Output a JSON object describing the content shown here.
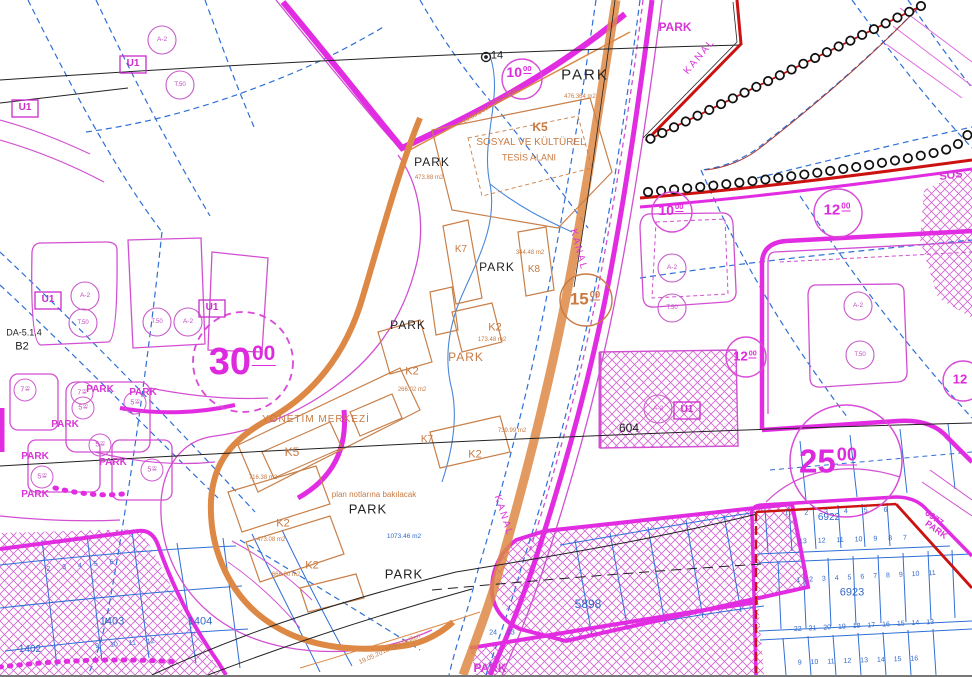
{
  "map": {
    "type": "turkish-zoning-cadastral-plan",
    "colors": {
      "magenta": "#de2ade",
      "magenta_thin": "#d24fd2",
      "blue": "#2f6fd6",
      "orange": "#d4813b",
      "orange_text": "#c87a42",
      "red": "#cc1111",
      "black": "#222222"
    },
    "labels": [
      {
        "id": "park-north",
        "t": "PARK",
        "x": 585,
        "y": 75,
        "s": 15,
        "c": "#222",
        "ls": 2
      },
      {
        "id": "park-k5-west",
        "t": "PARK",
        "x": 432,
        "y": 162,
        "s": 12,
        "c": "#222",
        "ls": 1
      },
      {
        "id": "park-center",
        "t": "PARK",
        "x": 497,
        "y": 267,
        "s": 12,
        "c": "#222",
        "ls": 1
      },
      {
        "id": "park-west",
        "t": "PARK",
        "x": 408,
        "y": 325,
        "s": 12,
        "c": "#222",
        "ls": 1
      },
      {
        "id": "park-south-1",
        "t": "PARK",
        "x": 368,
        "y": 509,
        "s": 13,
        "c": "#222",
        "ls": 1
      },
      {
        "id": "park-south-2",
        "t": "PARK",
        "x": 404,
        "y": 574,
        "s": 13,
        "c": "#222",
        "ls": 1
      },
      {
        "id": "point-14",
        "t": "14",
        "x": 497,
        "y": 56,
        "s": 11,
        "c": "#222"
      },
      {
        "id": "block-604",
        "t": "604",
        "x": 629,
        "y": 428,
        "s": 12,
        "c": "#222"
      },
      {
        "id": "plan-code-da514",
        "t": "DA-5.1.4",
        "x": 24,
        "y": 333,
        "s": 9,
        "c": "#222"
      },
      {
        "id": "plan-code-b2",
        "t": "B2",
        "x": 22,
        "y": 347,
        "s": 11,
        "c": "#222"
      },
      {
        "id": "park-orange",
        "t": "PARK",
        "x": 466,
        "y": 357,
        "s": 12,
        "c": "#c87a42",
        "ls": 1
      },
      {
        "id": "k5-title",
        "t": "K5",
        "x": 540,
        "y": 127,
        "s": 12,
        "c": "#c87a42",
        "b": 1
      },
      {
        "id": "k5-subtitle-1",
        "t": "SOSYAL VE KÜLTÜREL",
        "x": 531,
        "y": 143,
        "s": 10,
        "c": "#c87a42"
      },
      {
        "id": "k5-subtitle-2",
        "t": "TESİS ALANI",
        "x": 529,
        "y": 158,
        "s": 9,
        "c": "#c87a42"
      },
      {
        "id": "yonetim-merkezi",
        "t": "YÖNETİM MERKEZİ",
        "x": 316,
        "y": 420,
        "s": 10,
        "c": "#c87a42",
        "ls": 1
      },
      {
        "id": "k5-south",
        "t": "K5",
        "x": 292,
        "y": 452,
        "s": 12,
        "c": "#c87a42"
      },
      {
        "id": "k2-a",
        "t": "K2",
        "x": 412,
        "y": 372,
        "s": 11,
        "c": "#c87a42"
      },
      {
        "id": "k2-b",
        "t": "K2",
        "x": 495,
        "y": 328,
        "s": 11,
        "c": "#c87a42"
      },
      {
        "id": "k2-c",
        "t": "K2",
        "x": 475,
        "y": 455,
        "s": 11,
        "c": "#c87a42"
      },
      {
        "id": "k2-d",
        "t": "K2",
        "x": 283,
        "y": 524,
        "s": 11,
        "c": "#c87a42"
      },
      {
        "id": "k2-e",
        "t": "K2",
        "x": 312,
        "y": 566,
        "s": 11,
        "c": "#c87a42"
      },
      {
        "id": "k7-a",
        "t": "K7",
        "x": 461,
        "y": 250,
        "s": 10,
        "c": "#c87a42"
      },
      {
        "id": "k7-b",
        "t": "K7",
        "x": 427,
        "y": 440,
        "s": 10,
        "c": "#c87a42"
      },
      {
        "id": "k8",
        "t": "K8",
        "x": 534,
        "y": 270,
        "s": 10,
        "c": "#c87a42"
      },
      {
        "id": "area-1",
        "t": "476.364 m2",
        "x": 580,
        "y": 97,
        "s": 6,
        "c": "#c87a42"
      },
      {
        "id": "area-2",
        "t": "473.88 m2",
        "x": 429,
        "y": 178,
        "s": 6,
        "c": "#c87a42"
      },
      {
        "id": "area-3",
        "t": "266.02 m2",
        "x": 412,
        "y": 390,
        "s": 6,
        "c": "#c87a42"
      },
      {
        "id": "area-4",
        "t": "739.99 m2",
        "x": 512,
        "y": 431,
        "s": 6,
        "c": "#c87a42"
      },
      {
        "id": "area-5",
        "t": "716.38 m2",
        "x": 263,
        "y": 478,
        "s": 6,
        "c": "#c87a42"
      },
      {
        "id": "area-6",
        "t": "473.08 m2",
        "x": 271,
        "y": 540,
        "s": 6,
        "c": "#c87a42"
      },
      {
        "id": "area-7",
        "t": "666.00 m2",
        "x": 286,
        "y": 575,
        "s": 6,
        "c": "#c87a42"
      },
      {
        "id": "area-8",
        "t": "344.48 m2",
        "x": 530,
        "y": 253,
        "s": 6,
        "c": "#c87a42"
      },
      {
        "id": "area-9",
        "t": "173.48 m2",
        "x": 492,
        "y": 340,
        "s": 6,
        "c": "#c87a42"
      },
      {
        "id": "plan-note",
        "t": "plan notlarına bakılacak",
        "x": 374,
        "y": 495,
        "s": 8,
        "c": "#c87a42"
      },
      {
        "id": "revision-note-1",
        "t": "19.05.2018/280-tadilen",
        "x": 492,
        "y": 106,
        "s": 6.5,
        "c": "#c87a42",
        "r": -31
      },
      {
        "id": "revision-note-2",
        "t": "19.05.2018/280-tadilen",
        "x": 390,
        "y": 650,
        "s": 6.5,
        "c": "#c87a42",
        "r": -24
      },
      {
        "id": "width-15",
        "t": "15",
        "sup": "00",
        "x": 585,
        "y": 299,
        "s": 17,
        "c": "#c87a42",
        "b": 1
      },
      {
        "id": "park-left-1",
        "t": "PARK",
        "x": 100,
        "y": 390,
        "s": 10,
        "c": "#d836d8",
        "b": 1
      },
      {
        "id": "park-left-2",
        "t": "PARK",
        "x": 143,
        "y": 393,
        "s": 10,
        "c": "#d836d8",
        "b": 1
      },
      {
        "id": "park-left-3",
        "t": "PARK",
        "x": 65,
        "y": 425,
        "s": 10,
        "c": "#d836d8",
        "b": 1
      },
      {
        "id": "park-left-4",
        "t": "PARK",
        "x": 35,
        "y": 457,
        "s": 10,
        "c": "#d836d8",
        "b": 1
      },
      {
        "id": "park-left-5",
        "t": "PARK",
        "x": 113,
        "y": 463,
        "s": 10,
        "c": "#d836d8",
        "b": 1
      },
      {
        "id": "park-left-6",
        "t": "PARK",
        "x": 35,
        "y": 495,
        "s": 10,
        "c": "#d836d8",
        "b": 1
      },
      {
        "id": "park-topright",
        "t": "PARK",
        "x": 675,
        "y": 27,
        "s": 12,
        "c": "#d836d8",
        "b": 1
      },
      {
        "id": "park-bottom",
        "t": "PARK",
        "x": 490,
        "y": 668,
        "s": 12,
        "c": "#d836d8",
        "b": 1
      },
      {
        "id": "sos-cutoff",
        "t": "SOS",
        "x": 951,
        "y": 176,
        "s": 11,
        "c": "#d836d8",
        "b": 1,
        "r": -8
      },
      {
        "id": "kanal-1",
        "t": "KANAL",
        "x": 700,
        "y": 57,
        "s": 10,
        "c": "#d836d8",
        "ls": 2,
        "r": -50
      },
      {
        "id": "kanal-2",
        "t": "KANAL",
        "x": 578,
        "y": 250,
        "s": 10,
        "c": "#d836d8",
        "ls": 2,
        "r": 75
      },
      {
        "id": "kanal-3",
        "t": "KANAL",
        "x": 503,
        "y": 516,
        "s": 10,
        "c": "#d836d8",
        "ls": 2,
        "r": 72
      },
      {
        "id": "width-30",
        "t": "30",
        "sup": "00",
        "x": 242,
        "y": 362,
        "s": 38,
        "c": "#de2ade",
        "b": 1
      },
      {
        "id": "width-25",
        "t": "25",
        "sup": "00",
        "x": 828,
        "y": 461,
        "s": 33,
        "c": "#de2ade",
        "b": 1
      },
      {
        "id": "width-10-a",
        "t": "10",
        "sup": "00",
        "x": 519,
        "y": 72,
        "s": 14,
        "c": "#de2ade",
        "b": 1
      },
      {
        "id": "width-10-b",
        "t": "10",
        "sup": "00",
        "x": 671,
        "y": 210,
        "s": 14,
        "c": "#de2ade",
        "b": 1
      },
      {
        "id": "width-12-a",
        "t": "12",
        "sup": "00",
        "x": 837,
        "y": 210,
        "s": 15,
        "c": "#de2ade",
        "b": 1
      },
      {
        "id": "width-12-b",
        "t": "12",
        "sup": "00",
        "x": 745,
        "y": 356,
        "s": 13,
        "c": "#de2ade",
        "b": 1
      },
      {
        "id": "width-12-c",
        "t": "12",
        "x": 960,
        "y": 379,
        "s": 13,
        "c": "#de2ade",
        "b": 1
      },
      {
        "id": "block-6977",
        "t": "6977",
        "x": 934,
        "y": 518,
        "s": 9,
        "c": "#d836d8",
        "b": 1,
        "r": 36
      },
      {
        "id": "block-6977-park",
        "t": "PARK",
        "x": 936,
        "y": 530,
        "s": 9,
        "c": "#d836d8",
        "b": 1,
        "r": 36
      },
      {
        "id": "width-5-a",
        "t": "5",
        "sup": "00",
        "x": 83,
        "y": 408,
        "s": 7,
        "c": "#c04ac0"
      },
      {
        "id": "width-5-b",
        "t": "5",
        "sup": "00",
        "x": 135,
        "y": 403,
        "s": 7,
        "c": "#c04ac0"
      },
      {
        "id": "width-5-c",
        "t": "5",
        "sup": "00",
        "x": 100,
        "y": 445,
        "s": 7,
        "c": "#c04ac0"
      },
      {
        "id": "width-5-d",
        "t": "5",
        "sup": "00",
        "x": 42,
        "y": 477,
        "s": 7,
        "c": "#c04ac0"
      },
      {
        "id": "width-5-e",
        "t": "5",
        "sup": "00",
        "x": 152,
        "y": 470,
        "s": 7,
        "c": "#c04ac0"
      },
      {
        "id": "width-7-a",
        "t": "7",
        "sup": "00",
        "x": 25,
        "y": 390,
        "s": 7,
        "c": "#c04ac0"
      },
      {
        "id": "width-7-b",
        "t": "7",
        "sup": "00",
        "x": 82,
        "y": 393,
        "s": 7,
        "c": "#c04ac0"
      },
      {
        "id": "zone-a2-1",
        "t": "A-2",
        "x": 162,
        "y": 40,
        "s": 6.5,
        "c": "#c04ac0"
      },
      {
        "id": "zone-a2-2",
        "t": "A-2",
        "x": 85,
        "y": 296,
        "s": 6.5,
        "c": "#c04ac0"
      },
      {
        "id": "zone-a2-3",
        "t": "A-2",
        "x": 188,
        "y": 322,
        "s": 6.5,
        "c": "#c04ac0"
      },
      {
        "id": "zone-a2-4",
        "t": "A-2",
        "x": 672,
        "y": 268,
        "s": 6.5,
        "c": "#c04ac0"
      },
      {
        "id": "zone-a2-5",
        "t": "A-2",
        "x": 858,
        "y": 306,
        "s": 6.5,
        "c": "#c04ac0"
      },
      {
        "id": "zone-a2-6",
        "t": "A-2",
        "x": 658,
        "y": 409,
        "s": 6.5,
        "c": "#c04ac0"
      },
      {
        "id": "zone-t50-1",
        "t": "T.50",
        "x": 180,
        "y": 85,
        "s": 6,
        "c": "#c04ac0"
      },
      {
        "id": "zone-t50-2",
        "t": "T.50",
        "x": 83,
        "y": 323,
        "s": 6,
        "c": "#c04ac0"
      },
      {
        "id": "zone-t50-3",
        "t": "T.50",
        "x": 157,
        "y": 322,
        "s": 6,
        "c": "#c04ac0"
      },
      {
        "id": "zone-t50-4",
        "t": "T.50",
        "x": 672,
        "y": 308,
        "s": 6,
        "c": "#c04ac0"
      },
      {
        "id": "zone-t50-5",
        "t": "T.50",
        "x": 860,
        "y": 355,
        "s": 6,
        "c": "#c04ac0"
      },
      {
        "id": "zone-u1-1",
        "t": "U1",
        "x": 133,
        "y": 64,
        "s": 10,
        "c": "#cc2acc",
        "b": 1
      },
      {
        "id": "zone-u1-2",
        "t": "U1",
        "x": 25,
        "y": 108,
        "s": 10,
        "c": "#cc2acc",
        "b": 1
      },
      {
        "id": "zone-u1-3",
        "t": "U1",
        "x": 48,
        "y": 300,
        "s": 10,
        "c": "#cc2acc",
        "b": 1
      },
      {
        "id": "zone-u1-4",
        "t": "U1",
        "x": 212,
        "y": 308,
        "s": 10,
        "c": "#cc2acc",
        "b": 1
      },
      {
        "id": "zone-u1-5",
        "t": "U1",
        "x": 687,
        "y": 410,
        "s": 10,
        "c": "#cc2acc",
        "b": 1
      },
      {
        "id": "block-5898",
        "t": "5898",
        "x": 588,
        "y": 604,
        "s": 12,
        "c": "#3368c8"
      },
      {
        "id": "block-6922",
        "t": "6922",
        "x": 829,
        "y": 518,
        "s": 10,
        "c": "#3368c8"
      },
      {
        "id": "block-6923",
        "t": "6923",
        "x": 852,
        "y": 593,
        "s": 11,
        "c": "#3368c8"
      },
      {
        "id": "block-1403",
        "t": "1403",
        "x": 112,
        "y": 622,
        "s": 11,
        "c": "#3368c8"
      },
      {
        "id": "block-1404",
        "t": "1404",
        "x": 200,
        "y": 622,
        "s": 11,
        "c": "#3368c8"
      },
      {
        "id": "block-1402",
        "t": "1402",
        "x": 30,
        "y": 650,
        "s": 10,
        "c": "#3368c8"
      },
      {
        "id": "area-blue",
        "t": "1073.46 m2",
        "x": 404,
        "y": 537,
        "s": 6.5,
        "c": "#3368c8"
      },
      {
        "id": "parcel-row-1t",
        "t": "1 2 3 4 5 6",
        "x": 836,
        "y": 512,
        "s": 7,
        "c": "#3368c8",
        "ws": 14,
        "r": -2
      },
      {
        "id": "parcel-row-1b",
        "t": "13 12 11 10 9 8 7",
        "x": 853,
        "y": 540,
        "s": 7,
        "c": "#3368c8",
        "ws": 9,
        "r": -2
      },
      {
        "id": "parcel-row-2t",
        "t": "1 2 3 4 5 6 7 8 9 10 11",
        "x": 866,
        "y": 577,
        "s": 7,
        "c": "#3368c8",
        "ws": 7,
        "r": -3
      },
      {
        "id": "parcel-row-2b",
        "t": "22 21 20 19 18 17 16 15 14 13",
        "x": 864,
        "y": 626,
        "s": 7,
        "c": "#3368c8",
        "ws": 5,
        "r": -3
      },
      {
        "id": "parcel-row-3",
        "t": "9 10 11 12 13 14 15 16",
        "x": 858,
        "y": 661,
        "s": 7,
        "c": "#3368c8",
        "ws": 7,
        "r": -2
      },
      {
        "id": "parcel-row-canal",
        "t": "24 23",
        "x": 502,
        "y": 633,
        "s": 7,
        "c": "#3368c8",
        "ws": 8
      },
      {
        "id": "parcel-row-hatch-1",
        "t": "2 3 4 5 6",
        "x": 80,
        "y": 566,
        "s": 7,
        "c": "#3368c8",
        "ws": 10,
        "r": -6
      },
      {
        "id": "parcel-row-hatch-2",
        "t": "9 10 11 12",
        "x": 125,
        "y": 644,
        "s": 7,
        "c": "#3368c8",
        "ws": 9,
        "r": -5
      }
    ]
  }
}
